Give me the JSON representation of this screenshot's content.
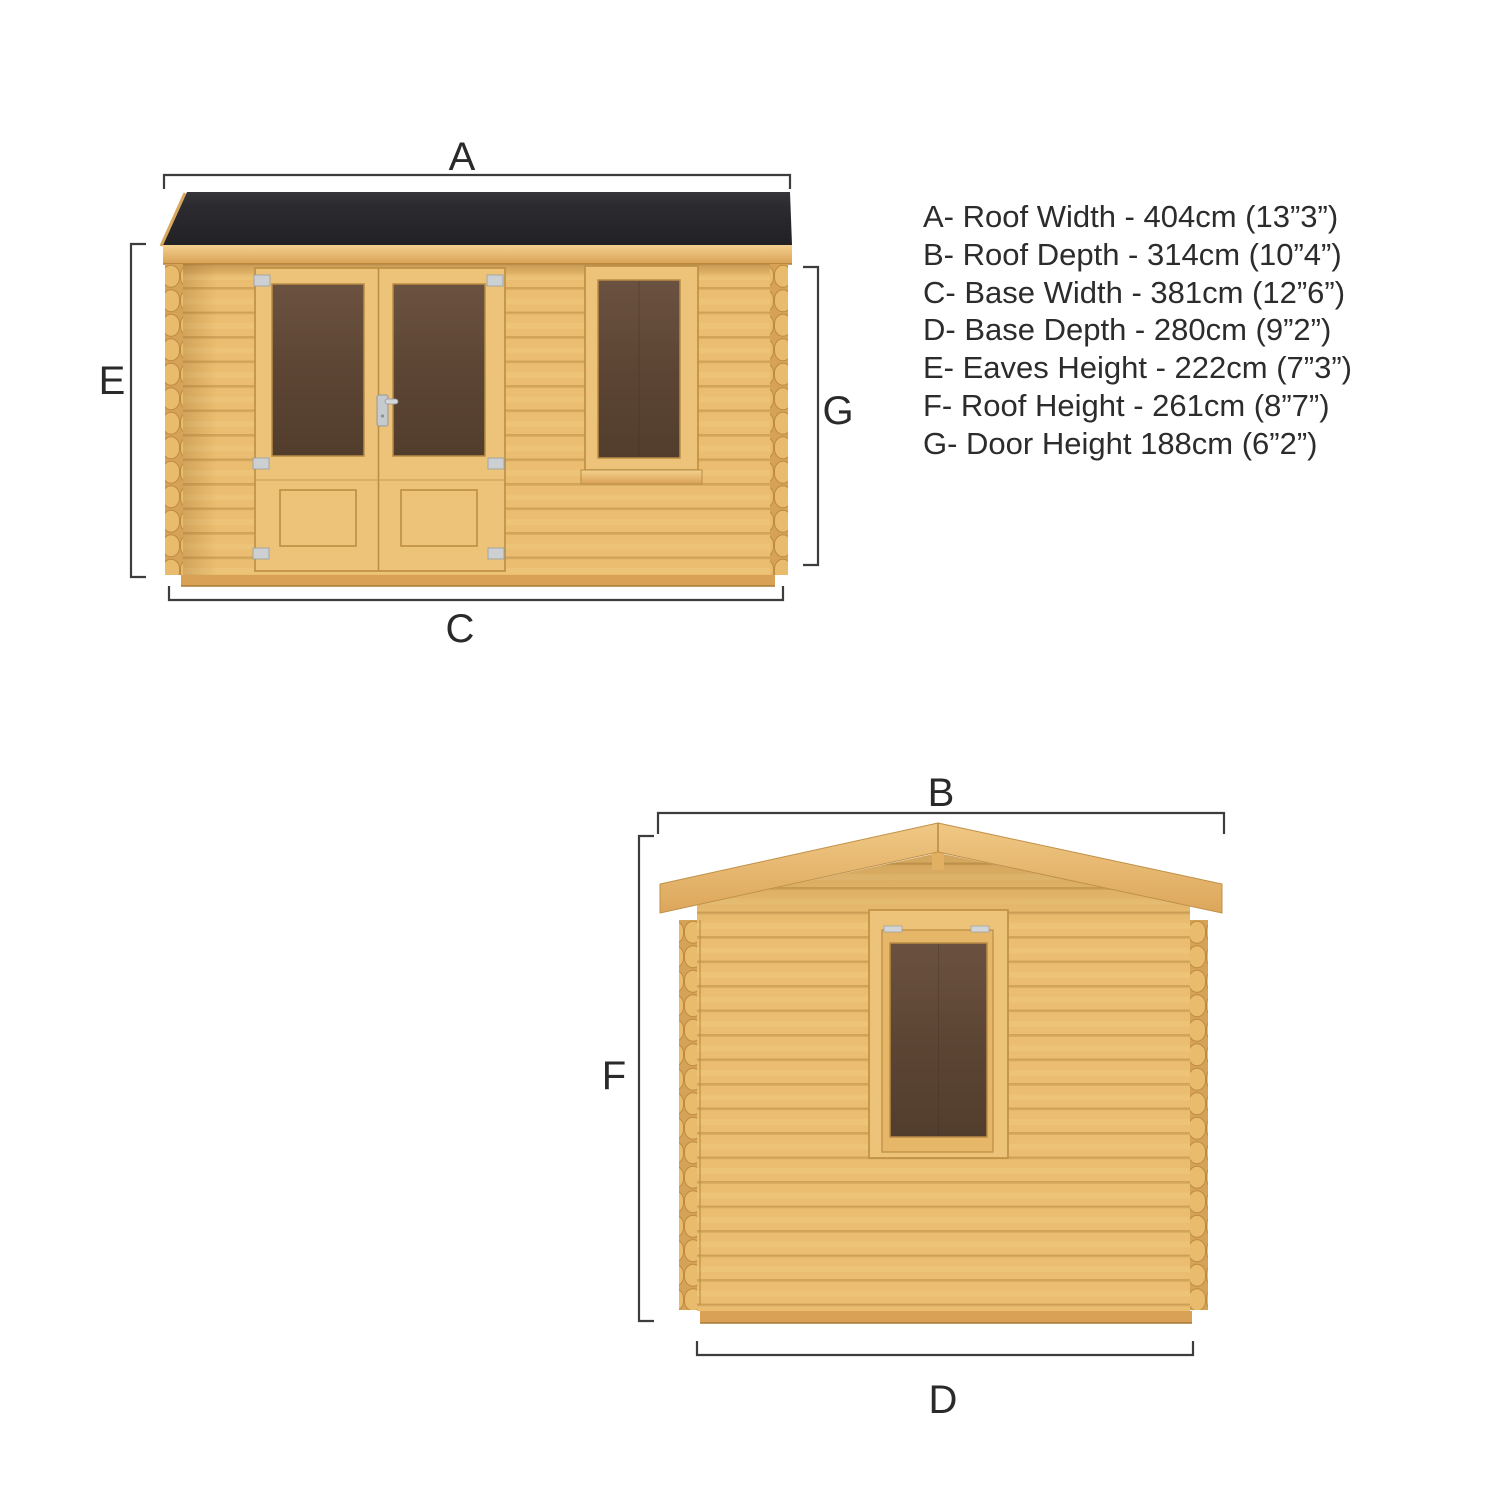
{
  "legend": {
    "items": [
      "A- Roof Width - 404cm (13”3”)",
      "B- Roof Depth - 314cm (10”4”)",
      "C- Base Width - 381cm (12”6”)",
      "D- Base Depth - 280cm (9”2”)",
      "E- Eaves Height - 222cm (7”3”)",
      "F- Roof Height - 261cm (8”7”)",
      "G- Door Height 188cm (6”2”)"
    ]
  },
  "front_view": {
    "dim_top": "A",
    "dim_left": "E",
    "dim_right": "G",
    "dim_bottom": "C"
  },
  "side_view": {
    "dim_top": "B",
    "dim_left": "F",
    "dim_bottom": "D"
  },
  "colors": {
    "background": "#ffffff",
    "wood": "#eabd70",
    "wood_edge": "#c2924a",
    "roof_felt": "#2a292c",
    "glass": "#5d4534",
    "dimension_line": "#3d3d3d",
    "text": "#2c2c2c"
  }
}
